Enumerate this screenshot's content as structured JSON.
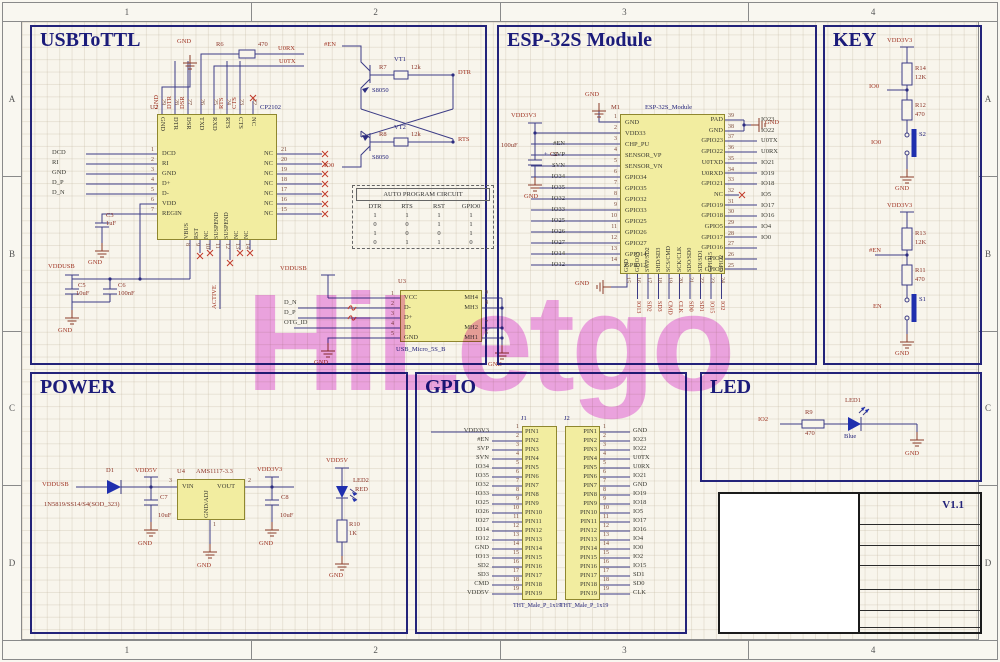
{
  "watermark": {
    "text": "HiLetgo",
    "color": "#f0a0ee"
  },
  "frame": {
    "cols": [
      "1",
      "2",
      "3",
      "4"
    ],
    "rows": [
      "A",
      "B",
      "C",
      "D"
    ]
  },
  "usb2ttl": {
    "title": "USBToTTL",
    "gnd": "GND",
    "u2": {
      "ref": "U2",
      "part": "CP2102",
      "left_pins": [
        {
          "num": "1",
          "name": "DCD"
        },
        {
          "num": "2",
          "name": "RI"
        },
        {
          "num": "3",
          "name": "GND"
        },
        {
          "num": "4",
          "name": "D+"
        },
        {
          "num": "5",
          "name": "D-"
        },
        {
          "num": "6",
          "name": "VDD"
        },
        {
          "num": "7",
          "name": "REGIN"
        }
      ],
      "right_pins": [
        {
          "num": "21",
          "name": "NC"
        },
        {
          "num": "20",
          "name": "NC"
        },
        {
          "num": "19",
          "name": "NC"
        },
        {
          "num": "18",
          "name": "NC"
        },
        {
          "num": "17",
          "name": "NC"
        },
        {
          "num": "16",
          "name": "NC"
        },
        {
          "num": "15",
          "name": "NC"
        }
      ],
      "top_pins": [
        {
          "num": "29",
          "name": "GND"
        },
        {
          "num": "28",
          "name": "DTR"
        },
        {
          "num": "27",
          "name": "DSR"
        },
        {
          "num": "26",
          "name": "TXD"
        },
        {
          "num": "25",
          "name": "RXD"
        },
        {
          "num": "24",
          "name": "RTS"
        },
        {
          "num": "23",
          "name": "CTS"
        },
        {
          "num": "22",
          "name": "NC"
        }
      ],
      "bottom_pins": [
        {
          "num": "8",
          "name": "VBUS"
        },
        {
          "num": "9",
          "name": "RST"
        },
        {
          "num": "10",
          "name": "NC"
        },
        {
          "num": "11",
          "name": "SUSPEND"
        },
        {
          "num": "12",
          "name": "SUSPEND"
        },
        {
          "num": "13",
          "name": "NC"
        },
        {
          "num": "14",
          "name": "NC"
        }
      ]
    },
    "left_nets": [
      "DCD",
      "RI",
      "GND",
      "D_P",
      "D_N"
    ],
    "top_nets": [
      "GND",
      "DTR",
      "DSR"
    ],
    "mid_nets": [
      "RTS",
      "CTS"
    ],
    "r6": {
      "ref": "R6",
      "value": "470"
    },
    "u0rx": "U0RX",
    "u0tx": "U0TX",
    "en_net": "#EN",
    "io0_net": "IO0",
    "dtr_net": "DTR",
    "rts_net": "RTS",
    "vt1": {
      "ref": "VT1",
      "part": "S8050"
    },
    "vt2": {
      "ref": "VT2",
      "part": "S8050"
    },
    "r7": {
      "ref": "R7",
      "value": "12k"
    },
    "r8": {
      "ref": "R8",
      "value": "12k"
    },
    "c3": {
      "ref": "C3",
      "value": "1uF"
    },
    "vddusb": "VDDUSB",
    "c5": {
      "ref": "C5",
      "value": "10uF"
    },
    "c6": {
      "ref": "C6",
      "value": "100nF"
    },
    "active": "ACTIVE",
    "table": {
      "title": "AUTO PROGRAM CIRCUIT",
      "headers": [
        "DTR",
        "RTS",
        "RST",
        "GPIO0"
      ],
      "rows": [
        {
          "a": "1",
          "b": "1",
          "c": "1",
          "d": "1"
        },
        {
          "a": "0",
          "b": "0",
          "c": "1",
          "d": "1"
        },
        {
          "a": "1",
          "b": "0",
          "c": "0",
          "d": "1"
        },
        {
          "a": "0",
          "b": "1",
          "c": "1",
          "d": "0"
        }
      ]
    },
    "u3": {
      "ref": "U3",
      "part": "USB_Micro_5S_B",
      "left_pins": [
        {
          "num": "1",
          "name": "VCC"
        },
        {
          "num": "2",
          "name": "D-"
        },
        {
          "num": "3",
          "name": "D+"
        },
        {
          "num": "4",
          "name": "ID"
        },
        {
          "num": "5",
          "name": "GND"
        }
      ],
      "right_pins": [
        {
          "num": "9",
          "name": "MH4"
        },
        {
          "num": "8",
          "name": "MH3"
        },
        {
          "num": "7",
          "name": "MH2"
        },
        {
          "num": "6",
          "name": "MH1"
        }
      ],
      "nets": [
        "D_N",
        "D_P",
        "OTG_ID"
      ]
    }
  },
  "esp": {
    "title": "ESP-32S Module",
    "gnd": "GND",
    "vdd": "VDD3V3",
    "c2": {
      "plus": "+",
      "ref": "C2",
      "value": "100uF"
    },
    "m1": {
      "ref": "M1",
      "part": "ESP-32S_Module",
      "left_pins": [
        {
          "num": "1",
          "name": "GND"
        },
        {
          "num": "2",
          "name": "VDD33"
        },
        {
          "num": "3",
          "name": "CHP_PU"
        },
        {
          "num": "4",
          "name": "SENSOR_VP"
        },
        {
          "num": "5",
          "name": "SENSOR_VN"
        },
        {
          "num": "6",
          "name": "GPIO34"
        },
        {
          "num": "7",
          "name": "GPIO35"
        },
        {
          "num": "8",
          "name": "GPIO32"
        },
        {
          "num": "9",
          "name": "GPIO33"
        },
        {
          "num": "10",
          "name": "GPIO25"
        },
        {
          "num": "11",
          "name": "GPIO26"
        },
        {
          "num": "12",
          "name": "GPIO27"
        },
        {
          "num": "13",
          "name": "GPIO14"
        },
        {
          "num": "14",
          "name": "GPIO12"
        }
      ],
      "right_pins": [
        {
          "num": "39",
          "name": "PAD"
        },
        {
          "num": "38",
          "name": "GND"
        },
        {
          "num": "37",
          "name": "GPIO23"
        },
        {
          "num": "36",
          "name": "GPIO22"
        },
        {
          "num": "35",
          "name": "U0TXD"
        },
        {
          "num": "34",
          "name": "U0RXD"
        },
        {
          "num": "33",
          "name": "GPIO21"
        },
        {
          "num": "32",
          "name": "NC"
        },
        {
          "num": "31",
          "name": "GPIO19"
        },
        {
          "num": "30",
          "name": "GPIO18"
        },
        {
          "num": "29",
          "name": "GPIO5"
        },
        {
          "num": "28",
          "name": "GPIO17"
        },
        {
          "num": "27",
          "name": "GPIO16"
        },
        {
          "num": "26",
          "name": "GPIO4"
        },
        {
          "num": "25",
          "name": "GPIO0"
        }
      ],
      "bottom_pins": [
        {
          "num": "15",
          "name": "GND"
        },
        {
          "num": "16",
          "name": "GPIO13"
        },
        {
          "num": "17",
          "name": "SWP/SD2"
        },
        {
          "num": "18",
          "name": "SHD/SD3"
        },
        {
          "num": "19",
          "name": "SCS/CMD"
        },
        {
          "num": "20",
          "name": "SCK/CLK"
        },
        {
          "num": "21",
          "name": "SDO/SD0"
        },
        {
          "num": "22",
          "name": "SDI/SD1"
        },
        {
          "num": "23",
          "name": "GPIO15"
        },
        {
          "num": "24",
          "name": "GPIO2"
        }
      ]
    },
    "left_nets": [
      "#EN",
      "SVP",
      "SVN",
      "IO34",
      "IO35",
      "IO32",
      "IO33",
      "IO25",
      "IO26",
      "IO27",
      "IO14",
      "IO12"
    ],
    "right_nets": [
      "",
      "",
      "IO23",
      "IO22",
      "U0TX",
      "U0RX",
      "IO21",
      "",
      "IO19",
      "IO18",
      "IO5",
      "IO17",
      "IO16",
      "IO4",
      "IO0"
    ],
    "bottom_nets": [
      "",
      "IO13",
      "SD2",
      "SD3",
      "CMD",
      "CLK",
      "SD0",
      "SD1",
      "IO15",
      "IO2"
    ]
  },
  "key": {
    "title": "KEY",
    "chains": [
      {
        "vcc": "VDD3V3",
        "r1_ref": "R14",
        "r1_val": "12K",
        "net": "IO0",
        "r2_ref": "R12",
        "r2_val": "470",
        "sw_ref": "S2",
        "sw_net": "IO0",
        "gnd": "GND"
      },
      {
        "vcc": "VDD3V3",
        "r1_ref": "R13",
        "r1_val": "12K",
        "net": "#EN",
        "r2_ref": "R11",
        "r2_val": "470",
        "sw_ref": "S1",
        "sw_net": "EN",
        "gnd": "GND"
      }
    ]
  },
  "power": {
    "title": "POWER",
    "gnd": "GND",
    "vddusb": "VDDUSB",
    "vdd5v": "VDD5V",
    "vdd3v3": "VDD3V3",
    "d1": {
      "ref": "D1",
      "part": "1N5819/SS14/S4(SOD_323)"
    },
    "c7": {
      "ref": "C7",
      "value": "10uF"
    },
    "c8": {
      "ref": "C8",
      "value": "10uF"
    },
    "u4": {
      "ref": "U4",
      "part": "AMS1117-3.3",
      "vin": "VIN",
      "vout": "VOUT",
      "gnd_adj": "GND/ADJ",
      "pin_in": "3",
      "pin_out": "2",
      "pin_gnd": "1"
    },
    "led2": {
      "ref": "LED2",
      "color": "RED"
    },
    "r10": {
      "ref": "R10",
      "value": "1K"
    }
  },
  "gpio": {
    "title": "GPIO",
    "j1": {
      "ref": "J1",
      "part": "THT_Male_P_1x19",
      "rows": [
        {
          "num": "1",
          "pin": "PIN1",
          "net": "VDD3V3"
        },
        {
          "num": "2",
          "pin": "PIN2",
          "net": "#EN"
        },
        {
          "num": "3",
          "pin": "PIN3",
          "net": "SVP"
        },
        {
          "num": "4",
          "pin": "PIN4",
          "net": "SVN"
        },
        {
          "num": "5",
          "pin": "PIN5",
          "net": "IO34"
        },
        {
          "num": "6",
          "pin": "PIN6",
          "net": "IO35"
        },
        {
          "num": "7",
          "pin": "PIN7",
          "net": "IO32"
        },
        {
          "num": "8",
          "pin": "PIN8",
          "net": "IO33"
        },
        {
          "num": "9",
          "pin": "PIN9",
          "net": "IO25"
        },
        {
          "num": "10",
          "pin": "PIN10",
          "net": "IO26"
        },
        {
          "num": "11",
          "pin": "PIN11",
          "net": "IO27"
        },
        {
          "num": "12",
          "pin": "PIN12",
          "net": "IO14"
        },
        {
          "num": "13",
          "pin": "PIN13",
          "net": "IO12"
        },
        {
          "num": "14",
          "pin": "PIN14",
          "net": "GND"
        },
        {
          "num": "15",
          "pin": "PIN15",
          "net": "IO13"
        },
        {
          "num": "16",
          "pin": "PIN16",
          "net": "SD2"
        },
        {
          "num": "17",
          "pin": "PIN17",
          "net": "SD3"
        },
        {
          "num": "18",
          "pin": "PIN18",
          "net": "CMD"
        },
        {
          "num": "19",
          "pin": "PIN19",
          "net": "VDD5V"
        }
      ]
    },
    "j2": {
      "ref": "J2",
      "part": "THT_Male_P_1x19",
      "rows": [
        {
          "num": "1",
          "pin": "PIN1",
          "net": "GND"
        },
        {
          "num": "2",
          "pin": "PIN2",
          "net": "IO23"
        },
        {
          "num": "3",
          "pin": "PIN3",
          "net": "IO22"
        },
        {
          "num": "4",
          "pin": "PIN4",
          "net": "U0TX"
        },
        {
          "num": "5",
          "pin": "PIN5",
          "net": "U0RX"
        },
        {
          "num": "6",
          "pin": "PIN6",
          "net": "IO21"
        },
        {
          "num": "7",
          "pin": "PIN7",
          "net": "GND"
        },
        {
          "num": "8",
          "pin": "PIN8",
          "net": "IO19"
        },
        {
          "num": "9",
          "pin": "PIN9",
          "net": "IO18"
        },
        {
          "num": "10",
          "pin": "PIN10",
          "net": "IO5"
        },
        {
          "num": "11",
          "pin": "PIN11",
          "net": "IO17"
        },
        {
          "num": "12",
          "pin": "PIN12",
          "net": "IO16"
        },
        {
          "num": "13",
          "pin": "PIN13",
          "net": "IO4"
        },
        {
          "num": "14",
          "pin": "PIN14",
          "net": "IO0"
        },
        {
          "num": "15",
          "pin": "PIN15",
          "net": "IO2"
        },
        {
          "num": "16",
          "pin": "PIN16",
          "net": "IO15"
        },
        {
          "num": "17",
          "pin": "PIN17",
          "net": "SD1"
        },
        {
          "num": "18",
          "pin": "PIN18",
          "net": "SD0"
        },
        {
          "num": "19",
          "pin": "PIN19",
          "net": "CLK"
        }
      ]
    }
  },
  "led": {
    "title": "LED",
    "net": "IO2",
    "r9": {
      "ref": "R9",
      "value": "470"
    },
    "led1": {
      "ref": "LED1",
      "color": "Blue"
    },
    "gnd": "GND"
  },
  "titleblock": {
    "version": "V1.1"
  }
}
